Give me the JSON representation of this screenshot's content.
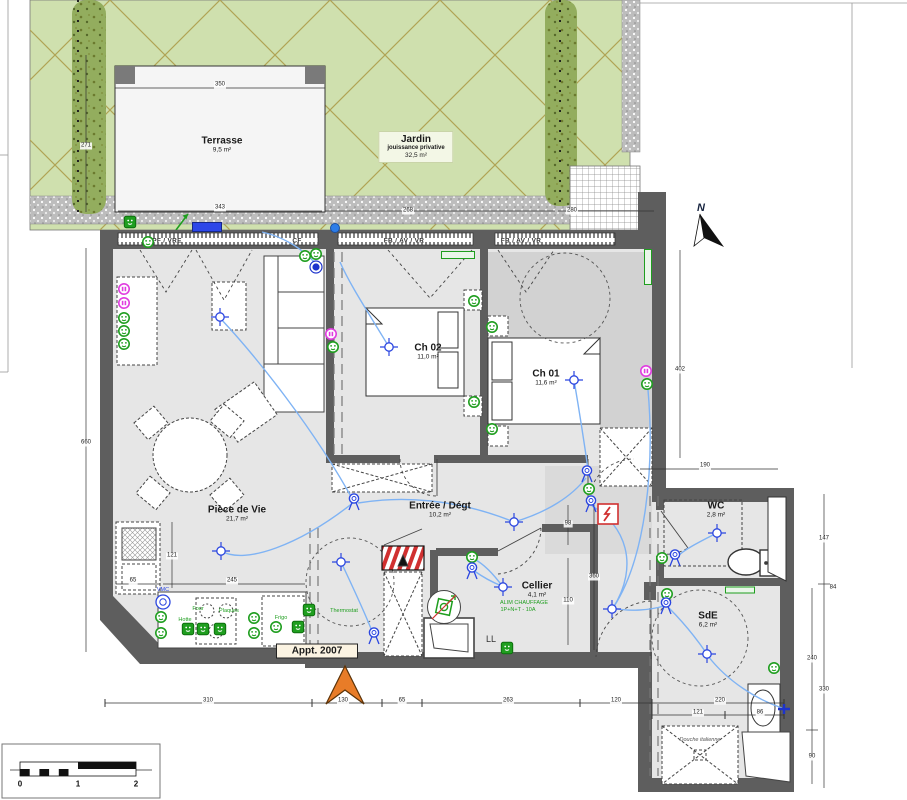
{
  "plan": {
    "apartment_label": "Appt. 2007",
    "north_label": "N",
    "rooms": [
      {
        "id": "terrasse",
        "name": "Terrasse",
        "area": "9,5 m²",
        "x": 222,
        "y": 145
      },
      {
        "id": "jardin",
        "name": "Jardin",
        "sub": "jouissance privative",
        "area": "32,5 m²",
        "x": 416,
        "y": 147
      },
      {
        "id": "ch02",
        "name": "Ch 02",
        "area": "11,0 m²",
        "x": 428,
        "y": 352
      },
      {
        "id": "ch01",
        "name": "Ch 01",
        "area": "11,6 m²",
        "x": 546,
        "y": 378
      },
      {
        "id": "piece-de-vie",
        "name": "Pièce de Vie",
        "area": "21,7 m²",
        "x": 237,
        "y": 514
      },
      {
        "id": "entree",
        "name": "Entrée / Dégt",
        "area": "10,2 m²",
        "x": 440,
        "y": 510
      },
      {
        "id": "cellier",
        "name": "Cellier",
        "area": "4,1 m²",
        "x": 537,
        "y": 590
      },
      {
        "id": "wc",
        "name": "WC",
        "area": "2,8 m²",
        "x": 716,
        "y": 510
      },
      {
        "id": "sde",
        "name": "SdE",
        "area": "6,2 m²",
        "x": 708,
        "y": 620
      }
    ],
    "window_labels": [
      {
        "text": "PF / VRE",
        "x": 167,
        "y": 241
      },
      {
        "text": "CF",
        "x": 297,
        "y": 241
      },
      {
        "text": "FB / AV / VR",
        "x": 404,
        "y": 241
      },
      {
        "text": "FB / AV / VR",
        "x": 521,
        "y": 241
      }
    ],
    "dimensions": [
      {
        "v": "350",
        "x": 220,
        "y": 85
      },
      {
        "v": "343",
        "x": 220,
        "y": 208
      },
      {
        "v": "268",
        "x": 408,
        "y": 211
      },
      {
        "v": "280",
        "x": 572,
        "y": 211
      },
      {
        "v": "271",
        "x": 86,
        "y": 146,
        "r": 1
      },
      {
        "v": "660",
        "x": 86,
        "y": 443,
        "r": 1
      },
      {
        "v": "402",
        "x": 680,
        "y": 370,
        "r": 1
      },
      {
        "v": "190",
        "x": 705,
        "y": 466
      },
      {
        "v": "147",
        "x": 824,
        "y": 539,
        "r": 1
      },
      {
        "v": "84",
        "x": 833,
        "y": 588,
        "r": 1
      },
      {
        "v": "330",
        "x": 824,
        "y": 690,
        "r": 1
      },
      {
        "v": "240",
        "x": 812,
        "y": 659,
        "r": 1
      },
      {
        "v": "90",
        "x": 812,
        "y": 757,
        "r": 1
      },
      {
        "v": "65",
        "x": 133,
        "y": 581
      },
      {
        "v": "245",
        "x": 232,
        "y": 581
      },
      {
        "v": "121",
        "x": 172,
        "y": 556,
        "r": 1
      },
      {
        "v": "98",
        "x": 568,
        "y": 524,
        "r": 1
      },
      {
        "v": "360",
        "x": 594,
        "y": 577,
        "r": 1
      },
      {
        "v": "110",
        "x": 568,
        "y": 601,
        "r": 1
      },
      {
        "v": "310",
        "x": 208,
        "y": 701
      },
      {
        "v": "130",
        "x": 343,
        "y": 701
      },
      {
        "v": "65",
        "x": 402,
        "y": 701
      },
      {
        "v": "263",
        "x": 508,
        "y": 701
      },
      {
        "v": "120",
        "x": 616,
        "y": 701
      },
      {
        "v": "220",
        "x": 720,
        "y": 701
      },
      {
        "v": "121",
        "x": 698,
        "y": 713
      },
      {
        "v": "86",
        "x": 760,
        "y": 713
      }
    ],
    "annotations": [
      {
        "text": "LL",
        "x": 491,
        "y": 639,
        "cls": "ll"
      },
      {
        "text": "ALIM CHAUFFAGE",
        "x": 524,
        "y": 603,
        "cls": "green-tiny"
      },
      {
        "text": "1P+N+T - 10A",
        "x": 518,
        "y": 610,
        "cls": "green-tiny"
      },
      {
        "text": "Thermostat",
        "x": 344,
        "y": 611,
        "cls": "green-tiny"
      },
      {
        "text": "VMC",
        "x": 163,
        "y": 590,
        "cls": "blue-tiny"
      },
      {
        "text": "Hotte",
        "x": 185,
        "y": 620,
        "cls": "green-tiny"
      },
      {
        "text": "Four",
        "x": 198,
        "y": 609,
        "cls": "green-tiny"
      },
      {
        "text": "Plaques",
        "x": 229,
        "y": 611,
        "cls": "green-tiny"
      },
      {
        "text": "Frigo",
        "x": 281,
        "y": 618,
        "cls": "green-tiny"
      },
      {
        "text": "Douche italienne",
        "x": 700,
        "y": 740,
        "cls": "shower-tiny"
      }
    ],
    "scale_labels": [
      {
        "text": "0",
        "x": 20,
        "y": 784
      },
      {
        "text": "1",
        "x": 78,
        "y": 784
      },
      {
        "text": "2",
        "x": 136,
        "y": 784
      }
    ],
    "symbols": {
      "outlets": [
        [
          124,
          318
        ],
        [
          124,
          331
        ],
        [
          124,
          344
        ],
        [
          305,
          256
        ],
        [
          316,
          254
        ],
        [
          333,
          347
        ],
        [
          474,
          301
        ],
        [
          492,
          327
        ],
        [
          474,
          402
        ],
        [
          492,
          429
        ],
        [
          647,
          384
        ],
        [
          589,
          489
        ],
        [
          472,
          557
        ],
        [
          161,
          617
        ],
        [
          161,
          633
        ],
        [
          254,
          618
        ],
        [
          254,
          633
        ],
        [
          276,
          627
        ],
        [
          662,
          558
        ],
        [
          667,
          594
        ],
        [
          774,
          668
        ],
        [
          148,
          242
        ]
      ],
      "rj45": [
        [
          124,
          289
        ],
        [
          124,
          303
        ],
        [
          331,
          334
        ],
        [
          646,
          371
        ]
      ],
      "lights": [
        [
          220,
          317
        ],
        [
          221,
          551
        ],
        [
          389,
          347
        ],
        [
          574,
          380
        ],
        [
          514,
          522
        ],
        [
          341,
          562
        ],
        [
          503,
          587
        ],
        [
          612,
          609
        ],
        [
          717,
          533
        ],
        [
          707,
          654
        ]
      ],
      "switches": [
        [
          354,
          502
        ],
        [
          374,
          636
        ],
        [
          587,
          474
        ],
        [
          591,
          504
        ],
        [
          472,
          571
        ],
        [
          675,
          558
        ],
        [
          666,
          606
        ]
      ],
      "taps": [
        [
          784,
          709
        ]
      ],
      "squares": [
        [
          130,
          222
        ],
        [
          188,
          629
        ],
        [
          203,
          629
        ],
        [
          220,
          629
        ],
        [
          298,
          627
        ],
        [
          309,
          610
        ],
        [
          507,
          648
        ]
      ],
      "bars": [
        {
          "x": 458,
          "y": 255,
          "w": 32,
          "h": 6
        },
        {
          "x": 648,
          "y": 267,
          "w": 6,
          "h": 34
        },
        {
          "x": 740,
          "y": 590,
          "w": 28,
          "h": 5
        }
      ],
      "detectors": [
        [
          316,
          267
        ]
      ],
      "vmc": [
        [
          163,
          602
        ]
      ],
      "panel": [
        [
          608,
          514
        ]
      ],
      "alim": [
        [
          444,
          607
        ]
      ],
      "roller": [
        [
          207,
          227
        ]
      ],
      "dots": [
        [
          335,
          228
        ]
      ]
    }
  }
}
